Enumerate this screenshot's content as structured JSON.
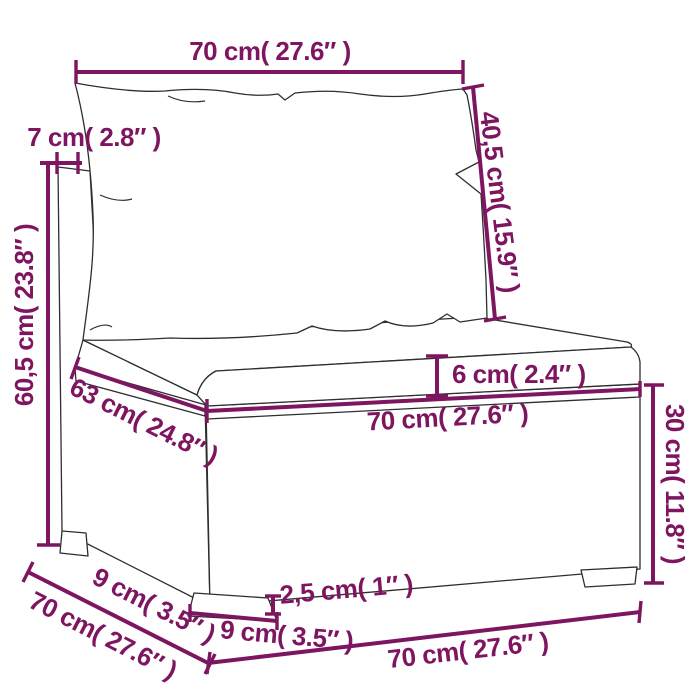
{
  "figure": {
    "title": "Rattan garden sofa middle section — dimension diagram",
    "background": "#FFFFFF"
  },
  "colors": {
    "dimension": "#7E1560",
    "line_art": "#2E2E2E",
    "background": "#FFFFFF"
  },
  "dims": {
    "top_width": "70 cm( 27.6″ )",
    "back_thickness": "7 cm( 2.8″ )",
    "total_height": "60,5 cm( 23.8″ )",
    "back_height": "40,5 cm( 15.9″ )",
    "cushion_thickness": "6 cm( 2.4″ )",
    "seat_depth": "63 cm( 24.8″ )",
    "seat_width": "70 cm( 27.6″ )",
    "base_height": "30 cm( 11.8″ )",
    "ground_clearance": "2,5 cm( 1″ )",
    "foot_width": "9 cm( 3.5″ )",
    "foot_depth": "9 cm( 3.5″ )",
    "total_depth": "70 cm( 27.6″ )",
    "bottom_width": "70 cm( 27.6″ )"
  }
}
